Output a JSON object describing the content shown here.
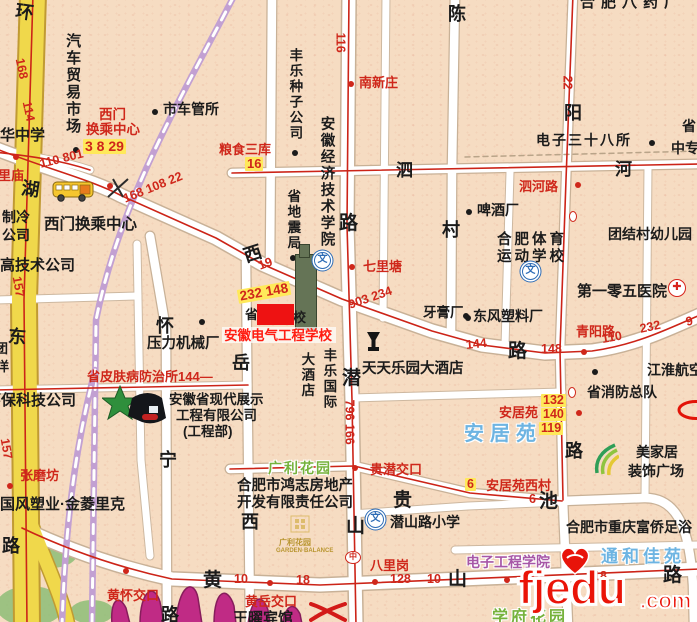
{
  "palette": {
    "k": "#1b1b1b",
    "r": "#cf271b",
    "b": "#6db4e2",
    "g": "#76b23c",
    "p": "#a757a7",
    "yellow_road": "#f0d84b",
    "white_road": "#ffffff",
    "rail": "#c2a0d2",
    "route_red": "#cc2418",
    "highlight": "#ffe95a",
    "red_box": "#ee1212",
    "watermark": "#ea1408",
    "mountain": "#c02b85"
  },
  "watermark": {
    "name": "fjedu",
    "tld": ".com"
  },
  "parks": [
    {
      "cx": 52,
      "cy": 552,
      "rx": 26,
      "ry": 16
    },
    {
      "cx": 30,
      "cy": 606,
      "rx": 34,
      "ry": 20
    },
    {
      "cx": 92,
      "cy": 612,
      "rx": 22,
      "ry": 12
    }
  ],
  "roads": [
    {
      "k": "yellow",
      "d": "M 33,-6 L 24,300 L 27,626",
      "name": "huanhu-east-road"
    },
    {
      "k": "yellowN",
      "d": "M 26,510 C 44,560 62,595 68,626",
      "name": "yellow-branch"
    },
    {
      "k": "white",
      "d": "M -6,148 C 50,170 92,180 122,196 L 216,238 L 262,264 L 342,299 L 432,331 L 482,345 L 545,353 L 592,351 C 634,345 664,331 700,315",
      "name": "changjiang-west-road"
    },
    {
      "k": "white",
      "d": "M 349,-6 L 347,225 L 352,400 L 356,626",
      "name": "qianshan-road"
    },
    {
      "k": "whiteM",
      "d": "M 232,173 L 700,164",
      "name": "sihe-road"
    },
    {
      "k": "white",
      "d": "M 22,528 C 64,548 112,566 172,579 L 320,585 L 700,569",
      "name": "huangshan-road"
    },
    {
      "k": "whiteM",
      "d": "M 230,469 L 354,466 L 470,493 L 562,501 L 644,498 C 680,497 690,535 693,585 L 694,626",
      "name": "guichi-road"
    },
    {
      "k": "whiteM",
      "d": "M 150,236 L 166,330 L 167,626",
      "name": "huaining-road"
    },
    {
      "k": "whiteM",
      "d": "M 246,262 L 250,626",
      "name": "yuexi-road"
    },
    {
      "k": "whiteM",
      "d": "M 455,-6 L 452,170 L 451,332",
      "name": "chencun-road"
    },
    {
      "k": "whiteM",
      "d": "M 573,-6 L 566,180 L 560,350 L 563,500 L 568,626",
      "name": "qingyang-road"
    },
    {
      "k": "whiteM",
      "d": "M 272,-6 L 270,268",
      "name": "minor-road"
    },
    {
      "k": "whiteS",
      "d": "M 386,-6 L 383,318",
      "name": "minor-road"
    },
    {
      "k": "whiteS",
      "d": "M 352,398 L 562,392",
      "name": "minor-road"
    },
    {
      "k": "whiteS",
      "d": "M 352,514 L 468,506 L 562,502",
      "name": "minor-road"
    },
    {
      "k": "whiteS",
      "d": "M 455,550 L 700,545",
      "name": "minor-road"
    },
    {
      "k": "whiteS",
      "d": "M -6,300 L 138,296",
      "name": "minor-road"
    },
    {
      "k": "whiteS",
      "d": "M 137,244 L 141,460 L 150,556",
      "name": "minor-road"
    },
    {
      "k": "whiteS",
      "d": "M -6,390 L 248,385",
      "name": "minor-road"
    },
    {
      "k": "whiteS",
      "d": "M 648,166 L 645,497",
      "name": "minor-road"
    },
    {
      "k": "whiteS",
      "d": "M 510,172 L 505,346",
      "name": "minor-road"
    },
    {
      "k": "whiteS",
      "d": "M -6,152 C 30,156 60,160 90,170",
      "name": "minor-road"
    },
    {
      "k": "rail",
      "d": "M 234,-4 C 180,100 120,200 96,320 L 92,626",
      "name": "railway"
    },
    {
      "k": "rail",
      "d": "M 95,370 C 80,430 66,500 62,626",
      "name": "railway"
    },
    {
      "k": "dash",
      "d": "M 465,157 L 700,151",
      "name": "boundary"
    },
    {
      "k": "red",
      "d": "M -6,148 C 50,170 92,180 122,196 L 216,238 L 262,264 L 342,299 L 432,331 L 482,345 L 545,353 L 592,351 C 634,345 664,331 700,315"
    },
    {
      "k": "red",
      "d": "M 349,-6 L 347,225 L 352,400 L 356,626"
    },
    {
      "k": "red",
      "d": "M 573,-6 L 566,180 L 560,350 L 563,500"
    },
    {
      "k": "red",
      "d": "M 22,528 C 64,548 112,566 172,579 L 320,585 L 700,569"
    },
    {
      "k": "red",
      "d": "M 33,-6 L 24,300 L 27,626"
    },
    {
      "k": "red",
      "d": "M -6,390 L 248,385"
    },
    {
      "k": "red",
      "d": "M 230,469 L 354,466 L 470,493 L 562,501"
    },
    {
      "k": "red",
      "d": "M 232,173 L 700,164"
    },
    {
      "k": "red",
      "d": "M -6,152 C 30,156 60,160 90,170"
    }
  ],
  "labels": [
    {
      "t": "汽车贸易市场",
      "x": 64,
      "y": 33,
      "v": 1,
      "s": 15
    },
    {
      "t": "华中学",
      "x": 0,
      "y": 127,
      "s": 15
    },
    {
      "t": "市车管所",
      "x": 163,
      "y": 102,
      "s": 14
    },
    {
      "t": "丰乐种子公司",
      "x": 287,
      "y": 48,
      "v": 1,
      "s": 13.5
    },
    {
      "t": "西门换乘中心",
      "x": 44,
      "y": 216,
      "s": 15.5
    },
    {
      "t": "高技术公司",
      "x": 0,
      "y": 257,
      "s": 15
    },
    {
      "t": "制冷",
      "x": 2,
      "y": 210,
      "s": 14
    },
    {
      "t": "公司",
      "x": 2,
      "y": 228,
      "s": 14
    },
    {
      "t": "团",
      "x": -5,
      "y": 342,
      "s": 13
    },
    {
      "t": "洋",
      "x": -4,
      "y": 360,
      "s": 13
    },
    {
      "t": "环保科技公司",
      "x": -14,
      "y": 392,
      "s": 15
    },
    {
      "t": "压力机械厂",
      "x": 147,
      "y": 336,
      "s": 14.5
    },
    {
      "t": "安徽省现代展示",
      "x": 169,
      "y": 392,
      "s": 13.5
    },
    {
      "t": "工程有限公司",
      "x": 176,
      "y": 408,
      "s": 13.5
    },
    {
      "t": "(工程部)",
      "x": 183,
      "y": 424,
      "s": 13.5
    },
    {
      "t": "国风塑业·金菱里克",
      "x": 0,
      "y": 496,
      "s": 15
    },
    {
      "t": "合肥市鸿志房地产",
      "x": 237,
      "y": 478,
      "s": 14.5
    },
    {
      "t": "开发有限责任公司",
      "x": 237,
      "y": 495,
      "s": 14.5
    },
    {
      "t": "天天乐园大酒店",
      "x": 362,
      "y": 361,
      "s": 14.5
    },
    {
      "t": "大酒店",
      "x": 299,
      "y": 352,
      "v": 1,
      "s": 13.5
    },
    {
      "t": "丰乐国际",
      "x": 321,
      "y": 348,
      "v": 1,
      "s": 13.5
    },
    {
      "t": "东风塑料厂",
      "x": 473,
      "y": 309,
      "s": 14
    },
    {
      "t": "牙膏厂",
      "x": 423,
      "y": 305,
      "s": 13.5
    },
    {
      "t": "啤酒厂",
      "x": 477,
      "y": 203,
      "s": 14
    },
    {
      "t": "合肥体育",
      "x": 497,
      "y": 232,
      "s": 14.5,
      "ls": 3
    },
    {
      "t": "运动学校",
      "x": 497,
      "y": 249,
      "s": 14.5,
      "ls": 3
    },
    {
      "t": "团结村幼儿园",
      "x": 608,
      "y": 227,
      "s": 14
    },
    {
      "t": "电子三十八所",
      "x": 536,
      "y": 133,
      "s": 14,
      "ls": 2
    },
    {
      "t": "省",
      "x": 682,
      "y": 119,
      "s": 14
    },
    {
      "t": "中专",
      "x": 671,
      "y": 141,
      "s": 14
    },
    {
      "t": "第一零五医院",
      "x": 577,
      "y": 283,
      "s": 15
    },
    {
      "t": "江淮航空",
      "x": 647,
      "y": 363,
      "s": 14
    },
    {
      "t": "省消防总队",
      "x": 587,
      "y": 385,
      "s": 14
    },
    {
      "t": "合肥市重庆富侨足浴",
      "x": 566,
      "y": 520,
      "s": 14
    },
    {
      "t": "潜山路小学",
      "x": 390,
      "y": 515,
      "s": 14
    },
    {
      "t": "美家居",
      "x": 636,
      "y": 445,
      "s": 14
    },
    {
      "t": "装饰广场",
      "x": 628,
      "y": 464,
      "s": 14
    },
    {
      "t": "王曜宾馆",
      "x": 233,
      "y": 610,
      "s": 15,
      "z": 6
    },
    {
      "t": "合肥八药厂",
      "x": 580,
      "y": -6,
      "s": 15,
      "ls": 6
    },
    {
      "t": "安徽经济技术学院",
      "x": 318,
      "y": 116,
      "v": 1,
      "s": 14.5
    },
    {
      "t": "省地震局",
      "x": 285,
      "y": 189,
      "v": 1,
      "s": 13.5
    },
    {
      "t": "西门",
      "x": 99,
      "y": 107,
      "c": "r",
      "s": 13.5
    },
    {
      "t": "换乘中心",
      "x": 86,
      "y": 122,
      "c": "r",
      "s": 13.5
    },
    {
      "t": "南新庄",
      "x": 359,
      "y": 76,
      "c": "r",
      "s": 13
    },
    {
      "t": "七里塘",
      "x": 363,
      "y": 260,
      "c": "r",
      "s": 13
    },
    {
      "t": "泗河路",
      "x": 519,
      "y": 180,
      "c": "r",
      "s": 13
    },
    {
      "t": "青阳路",
      "x": 576,
      "y": 325,
      "c": "r",
      "s": 13
    },
    {
      "t": "省皮肤病防治所144—",
      "x": 87,
      "y": 370,
      "c": "r",
      "s": 13
    },
    {
      "t": "安居苑",
      "x": 499,
      "y": 406,
      "c": "r",
      "s": 13
    },
    {
      "t": "安居苑西村",
      "x": 486,
      "y": 479,
      "c": "r",
      "s": 13
    },
    {
      "t": "贵潜交口",
      "x": 370,
      "y": 463,
      "c": "r",
      "s": 13
    },
    {
      "t": "八里岗",
      "x": 370,
      "y": 559,
      "c": "r",
      "s": 13
    },
    {
      "t": "黄怀交口",
      "x": 107,
      "y": 589,
      "c": "r",
      "s": 13,
      "z": 6
    },
    {
      "t": "黄岳交口",
      "x": 245,
      "y": 595,
      "c": "r",
      "s": 13,
      "z": 6
    },
    {
      "t": "张磨坊",
      "x": 20,
      "y": 469,
      "c": "r",
      "s": 13
    },
    {
      "t": "里庙",
      "x": -2,
      "y": 169,
      "c": "r",
      "s": 13
    },
    {
      "t": "粮食三库",
      "x": 219,
      "y": 143,
      "c": "r",
      "s": 13
    },
    {
      "t": "安居苑",
      "x": 464,
      "y": 423,
      "c": "b",
      "s": 20,
      "ls": 6,
      "halo": 1
    },
    {
      "t": "通和佳苑",
      "x": 601,
      "y": 547,
      "c": "b",
      "s": 17,
      "ls": 4,
      "halo": 1
    },
    {
      "t": "电子工程学院",
      "x": 466,
      "y": 555,
      "c": "p",
      "s": 14,
      "halo": 1
    },
    {
      "t": "广利花园",
      "x": 268,
      "y": 461,
      "c": "g",
      "s": 14,
      "ls": 2,
      "halo": 1
    },
    {
      "t": "学府花园",
      "x": 492,
      "y": 609,
      "c": "g",
      "s": 16,
      "ls": 3,
      "halo": 1
    },
    {
      "t": "广利花园",
      "x": 279,
      "y": 538,
      "c": "#b8952f",
      "s": 8,
      "z": 4
    },
    {
      "t": "GARDEN·BALANCE",
      "x": 276,
      "y": 548,
      "c": "#b8952f",
      "s": 6,
      "z": 4
    },
    {
      "t": "环",
      "x": 17,
      "y": 1,
      "s": 18,
      "rot": 8
    },
    {
      "t": "湖",
      "x": 23,
      "y": 178,
      "s": 18,
      "rot": 8
    },
    {
      "t": "东",
      "x": 9,
      "y": 326,
      "s": 18,
      "rot": 5
    },
    {
      "t": "路",
      "x": 2,
      "y": 536,
      "s": 18
    },
    {
      "t": "西",
      "x": 241,
      "y": 247,
      "s": 18,
      "rot": -18
    },
    {
      "t": "路",
      "x": 508,
      "y": 341,
      "s": 19
    },
    {
      "t": "路",
      "x": 339,
      "y": 213,
      "s": 19
    },
    {
      "t": "潜",
      "x": 342,
      "y": 368,
      "s": 19
    },
    {
      "t": "山",
      "x": 346,
      "y": 516,
      "s": 19
    },
    {
      "t": "怀",
      "x": 156,
      "y": 316,
      "s": 18
    },
    {
      "t": "宁",
      "x": 159,
      "y": 450,
      "s": 18
    },
    {
      "t": "路",
      "x": 161,
      "y": 605,
      "s": 18
    },
    {
      "t": "岳",
      "x": 232,
      "y": 353,
      "s": 18
    },
    {
      "t": "西",
      "x": 241,
      "y": 512,
      "s": 18
    },
    {
      "t": "陈",
      "x": 448,
      "y": 4,
      "s": 18
    },
    {
      "t": "村",
      "x": 442,
      "y": 220,
      "s": 18
    },
    {
      "t": "阳",
      "x": 564,
      "y": 103,
      "s": 18
    },
    {
      "t": "路",
      "x": 565,
      "y": 441,
      "s": 18
    },
    {
      "t": "泗",
      "x": 396,
      "y": 161,
      "s": 17
    },
    {
      "t": "河",
      "x": 615,
      "y": 160,
      "s": 17
    },
    {
      "t": "黄",
      "x": 203,
      "y": 570,
      "s": 19,
      "z": 6
    },
    {
      "t": "山",
      "x": 448,
      "y": 569,
      "s": 19
    },
    {
      "t": "贵",
      "x": 393,
      "y": 490,
      "s": 19
    },
    {
      "t": "池",
      "x": 539,
      "y": 491,
      "s": 19
    },
    {
      "t": "路",
      "x": 663,
      "y": 565,
      "s": 19
    },
    {
      "t": "省",
      "x": 245,
      "y": 308,
      "s": 13
    },
    {
      "t": "校",
      "x": 293,
      "y": 311,
      "s": 13
    },
    {
      "t": "安徽电气工程学校",
      "x": 224,
      "y": 328,
      "c": "#ff1d12",
      "s": 13.5,
      "z": 8
    }
  ],
  "nums": [
    {
      "t": "168",
      "x": 19,
      "y": 52,
      "rot": 78
    },
    {
      "t": "114",
      "x": 26,
      "y": 95,
      "rot": 78
    },
    {
      "t": "157",
      "x": 16,
      "y": 270,
      "rot": 80
    },
    {
      "t": "157",
      "x": 4,
      "y": 432,
      "rot": 80
    },
    {
      "t": "110 801",
      "x": 40,
      "y": 158,
      "rot": -14
    },
    {
      "t": "168 108 22",
      "x": 124,
      "y": 193,
      "rot": -22
    },
    {
      "t": "19",
      "x": 259,
      "y": 260,
      "rot": -20
    },
    {
      "t": "3 8 29",
      "x": 83,
      "y": 139,
      "hl": 1,
      "s": 14
    },
    {
      "t": "16",
      "x": 245,
      "y": 157,
      "hl": 1,
      "s": 13
    },
    {
      "t": "232 148",
      "x": 238,
      "y": 290,
      "rot": -10,
      "hl": 1,
      "s": 13.5
    },
    {
      "t": "903 234",
      "x": 349,
      "y": 299,
      "rot": -19
    },
    {
      "t": "144",
      "x": 466,
      "y": 339,
      "rot": -6
    },
    {
      "t": "148",
      "x": 541,
      "y": 343
    },
    {
      "t": "110",
      "x": 602,
      "y": 333,
      "rot": -10
    },
    {
      "t": "232",
      "x": 640,
      "y": 323,
      "rot": -12
    },
    {
      "t": "9",
      "x": 686,
      "y": 316,
      "rot": -12
    },
    {
      "t": "116",
      "x": 340,
      "y": 26,
      "rot": 90
    },
    {
      "t": "796 166",
      "x": 349,
      "y": 393,
      "rot": 90
    },
    {
      "t": "22",
      "x": 567,
      "y": 69,
      "rot": 90
    },
    {
      "t": "132",
      "x": 541,
      "y": 394,
      "hl": 1
    },
    {
      "t": "140",
      "x": 541,
      "y": 408,
      "hl": 1
    },
    {
      "t": "119",
      "x": 539,
      "y": 422,
      "hl": 1
    },
    {
      "t": "6",
      "x": 465,
      "y": 478,
      "hl": 1
    },
    {
      "t": "6",
      "x": 529,
      "y": 493
    },
    {
      "t": "10",
      "x": 234,
      "y": 573
    },
    {
      "t": "18",
      "x": 296,
      "y": 574
    },
    {
      "t": "128",
      "x": 390,
      "y": 573
    },
    {
      "t": "10",
      "x": 427,
      "y": 573
    },
    {
      "t": "18",
      "x": 593,
      "y": 570
    }
  ],
  "dots": [
    {
      "x": 73,
      "y": 147,
      "c": "k"
    },
    {
      "x": 152,
      "y": 109,
      "c": "k"
    },
    {
      "x": 292,
      "y": 150,
      "c": "k"
    },
    {
      "x": 290,
      "y": 255,
      "c": "k"
    },
    {
      "x": 199,
      "y": 319,
      "c": "k"
    },
    {
      "x": 465,
      "y": 315,
      "c": "k"
    },
    {
      "x": 463,
      "y": 313,
      "c": "k"
    },
    {
      "x": 466,
      "y": 209,
      "c": "k"
    },
    {
      "x": 649,
      "y": 140,
      "c": "k"
    },
    {
      "x": 592,
      "y": 369,
      "c": "k"
    },
    {
      "x": 348,
      "y": 81,
      "c": "r"
    },
    {
      "x": 349,
      "y": 264,
      "c": "r"
    },
    {
      "x": 575,
      "y": 182,
      "c": "r"
    },
    {
      "x": 7,
      "y": 483,
      "c": "r"
    },
    {
      "x": 352,
      "y": 465,
      "c": "r"
    },
    {
      "x": 123,
      "y": 568,
      "c": "r"
    },
    {
      "x": 267,
      "y": 580,
      "c": "r"
    },
    {
      "x": 372,
      "y": 579,
      "c": "r"
    },
    {
      "x": 504,
      "y": 577,
      "c": "r"
    },
    {
      "x": 581,
      "y": 349,
      "c": "r"
    },
    {
      "x": 576,
      "y": 410,
      "c": "r"
    },
    {
      "x": 107,
      "y": 183,
      "c": "r"
    },
    {
      "x": 13,
      "y": 154,
      "c": "r"
    }
  ],
  "rings": [
    {
      "x": 569,
      "y": 211
    },
    {
      "x": 568,
      "y": 387
    }
  ],
  "rects": [
    {
      "x": 257,
      "y": 304,
      "w": 37,
      "h": 21,
      "f": "#ee1212",
      "z": 7,
      "name": "red-highlight-box"
    },
    {
      "x": 222,
      "y": 327,
      "w": 114,
      "h": 16,
      "f": "rgba(255,255,255,0.7)",
      "z": 6,
      "name": "annotation-band"
    },
    {
      "x": 295,
      "y": 254,
      "w": 20,
      "h": 74,
      "f": "#657456",
      "b": "#39452f",
      "z": 4,
      "name": "building-footprint"
    },
    {
      "x": 299,
      "y": 244,
      "w": 9,
      "h": 12,
      "f": "#657456",
      "b": "#39452f",
      "z": 4,
      "name": "building-footprint"
    }
  ],
  "icons": [
    {
      "k": "school",
      "x": 314,
      "y": 252
    },
    {
      "k": "school",
      "x": 522,
      "y": 263
    },
    {
      "k": "school",
      "x": 367,
      "y": 511
    },
    {
      "k": "hospital",
      "x": 668,
      "y": 279
    },
    {
      "k": "bus",
      "x": 52,
      "y": 179
    },
    {
      "k": "goblet",
      "x": 366,
      "y": 331
    },
    {
      "k": "starlogo",
      "x": 102,
      "y": 384
    },
    {
      "k": "swirl",
      "x": 593,
      "y": 443
    },
    {
      "k": "crossing",
      "x": 106,
      "y": 177
    },
    {
      "k": "redx",
      "x": 309,
      "y": 602,
      "z": 7
    },
    {
      "k": "gardenlogo",
      "x": 277,
      "y": 515
    },
    {
      "k": "mountain",
      "x": 106,
      "y": 578,
      "z": 3
    },
    {
      "k": "zhong",
      "x": 345,
      "y": 551
    },
    {
      "k": "redoval",
      "x": 676,
      "y": 400
    }
  ]
}
